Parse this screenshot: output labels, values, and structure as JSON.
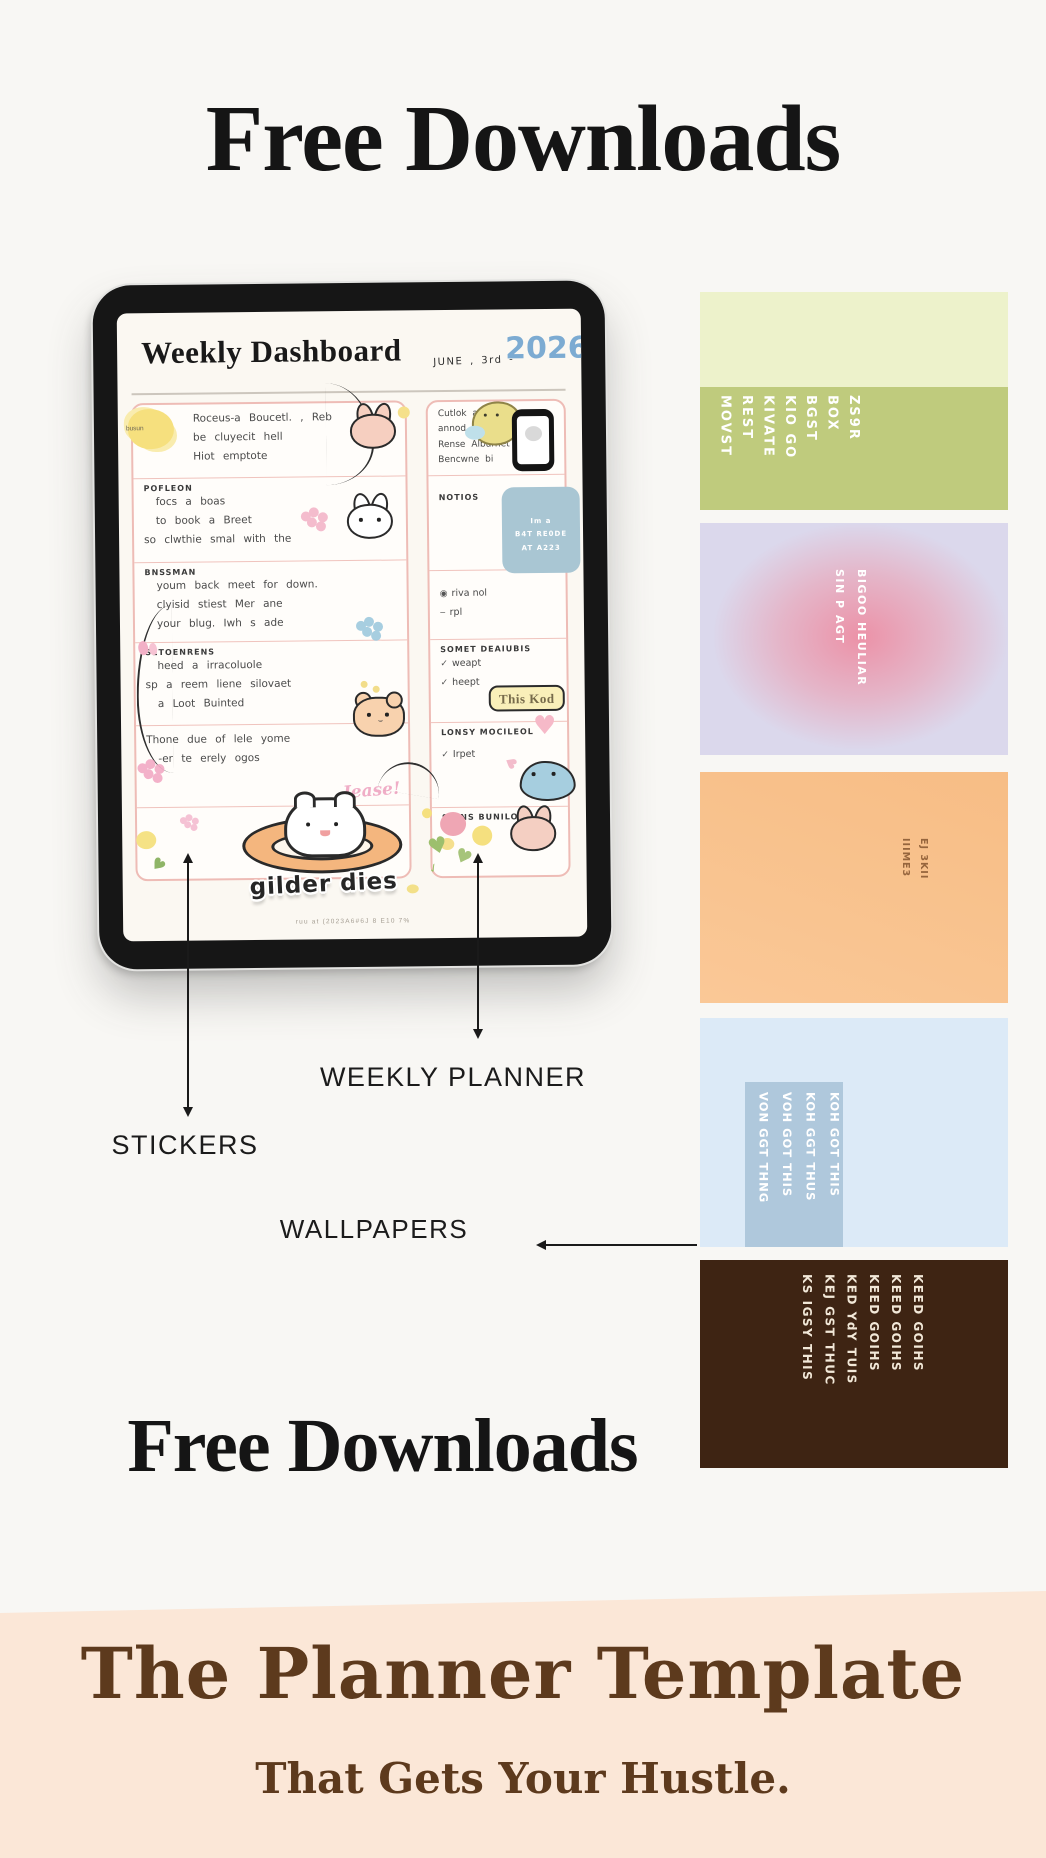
{
  "page": {
    "bg": "#f8f7f4",
    "title_top": "Free Downloads",
    "title_bottom": "Free Downloads"
  },
  "tablet": {
    "screen_title": "Weekly Dashboard",
    "date_prefix": "JUNE , 3rd -",
    "date_year": "2026",
    "sun_label": "busun",
    "left_sections": [
      {
        "heading": "",
        "lines": [
          "Roceus-a Boucetl. , Reb",
          "be cluyecit hell",
          "Hiot emptote"
        ]
      },
      {
        "heading": "Pofleon",
        "lines": [
          "focs a boas",
          "to book a Breet",
          "so clwthie smal with the"
        ]
      },
      {
        "heading": "Bnssman",
        "lines": [
          "youm back meet for down.",
          "clyisid stiest Mer ane",
          "your blug. Iwh s ade"
        ]
      },
      {
        "heading": "Setoenrens",
        "lines": [
          "heed a irracoluole",
          "sp a reem liene silovaet",
          "a Loot Buinted"
        ]
      },
      {
        "heading": "",
        "lines": [
          "Thone due of lele yome",
          "-er te erely ogos"
        ],
        "accent": "Jease!"
      }
    ],
    "right_sections": [
      {
        "lines": [
          "Cutlok alloa",
          "annod s",
          "Rense Alburnet",
          "Bencwne bi"
        ]
      },
      {
        "heading": "Notios",
        "note_lines": [
          "Im a",
          "B4T RE0DE",
          "AT A223"
        ]
      },
      {
        "items": [
          "riva nol",
          "rpl"
        ]
      },
      {
        "heading": "Somet Deaiubis",
        "items": [
          "weapt",
          "heept"
        ],
        "badge": "This Kod"
      },
      {
        "heading": "Lonsy Mocileol",
        "items": [
          "Irpet"
        ]
      },
      {
        "heading": "Suins Bunilon"
      }
    ],
    "sticker_caption": "gilder dies",
    "fine_print": "ruu at (2023A6#6J 8 E10 7%"
  },
  "labels": {
    "weekly_planner": "WEEKLY PLANNER",
    "stickers": "STICKERS",
    "wallpapers": "WALLPAPERS"
  },
  "swatches": [
    {
      "name": "green-quote-wallpaper",
      "top_color": "#edf2cb",
      "bottom_color": "#bfcb7d",
      "text_color": "#ffffff",
      "lines": [
        "ZS9R",
        "BOX",
        "BGST",
        "KIO GO",
        "KIVATE",
        "REST",
        "MOVST"
      ]
    },
    {
      "name": "lavender-gradient-wallpaper",
      "bg": "#dbd8ec",
      "glow": "#ef9cab",
      "text_color": "#ffffff",
      "lines": [
        "BIGOO HEULIAR",
        "SIN P AGT"
      ]
    },
    {
      "name": "orange-wallpaper",
      "bg": "#f8c28d",
      "text_color": "#96653d",
      "lines": [
        "EJ 3KII",
        "IIIME3"
      ]
    },
    {
      "name": "blue-quote-wallpaper",
      "bg": "#dceaf7",
      "panel": "#b5cce0",
      "text_color": "#ffffff",
      "lines": [
        "KOH GOT THIS",
        "KOH GGT THUS",
        "VOH GOT THIS",
        "VON GGT THNG"
      ]
    },
    {
      "name": "brown-quote-wallpaper",
      "bg": "#3e2413",
      "text_color": "#f2e8d8",
      "lines": [
        "KEED GOIHS",
        "KEED GOIHS",
        "KEED GOIHS",
        "KED YdY TUIS",
        "KEJ GST THUC",
        "KS IGSY THIS"
      ]
    }
  ],
  "footer": {
    "bg": "#fbe7d7",
    "text_color": "#5d3a1d",
    "title": "The Planner Template",
    "subtitle": "That Gets Your Hustle."
  }
}
